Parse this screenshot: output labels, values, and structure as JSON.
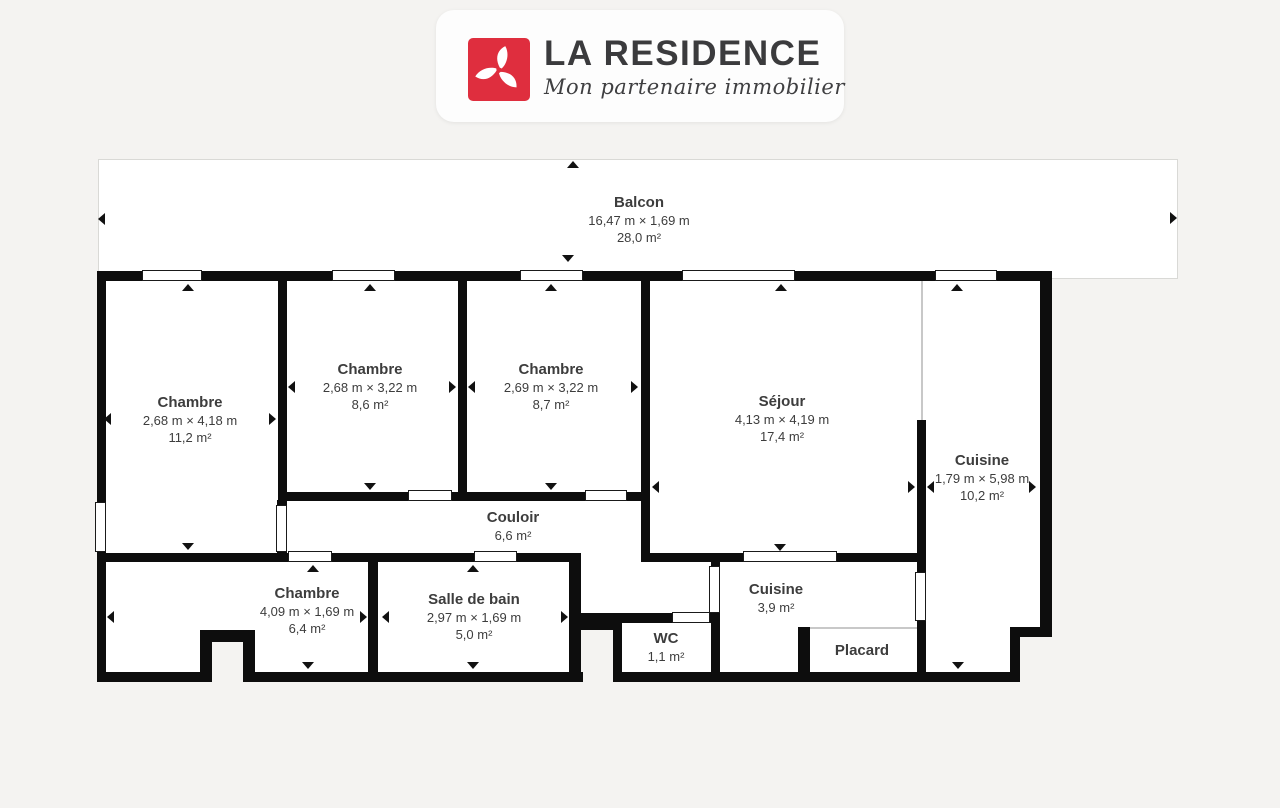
{
  "logo": {
    "title": "LA RESIDENCE",
    "tagline": "Mon partenaire immobilier",
    "brand_color": "#df2e3e",
    "title_color": "#3b3b3d"
  },
  "plan": {
    "wall_color": "#0d0d0d",
    "background_color": "#f4f3f1",
    "room_fill_color": "#ffffff",
    "text_color": "#3d3d3d"
  },
  "rooms": [
    {
      "id": "balcon",
      "name": "Balcon",
      "dims": "16,47 m × 1,69 m",
      "area": "28,0 m²"
    },
    {
      "id": "chambre-1",
      "name": "Chambre",
      "dims": "2,68 m × 4,18 m",
      "area": "11,2 m²"
    },
    {
      "id": "chambre-2",
      "name": "Chambre",
      "dims": "2,68 m × 3,22 m",
      "area": "8,6 m²"
    },
    {
      "id": "chambre-3",
      "name": "Chambre",
      "dims": "2,69 m × 3,22 m",
      "area": "8,7 m²"
    },
    {
      "id": "sejour",
      "name": "Séjour",
      "dims": "4,13 m × 4,19 m",
      "area": "17,4 m²"
    },
    {
      "id": "cuisine",
      "name": "Cuisine",
      "dims": "1,79 m × 5,98 m",
      "area": "10,2 m²"
    },
    {
      "id": "couloir",
      "name": "Couloir",
      "dims": null,
      "area": "6,6 m²"
    },
    {
      "id": "chambre-4",
      "name": "Chambre",
      "dims": "4,09 m × 1,69 m",
      "area": "6,4 m²"
    },
    {
      "id": "salle-de-bain",
      "name": "Salle de bain",
      "dims": "2,97 m × 1,69 m",
      "area": "5,0 m²"
    },
    {
      "id": "wc",
      "name": "WC",
      "dims": null,
      "area": "1,1 m²"
    },
    {
      "id": "cuisine-2",
      "name": "Cuisine",
      "dims": null,
      "area": "3,9 m²"
    },
    {
      "id": "placard",
      "name": "Placard",
      "dims": null,
      "area": null
    }
  ]
}
